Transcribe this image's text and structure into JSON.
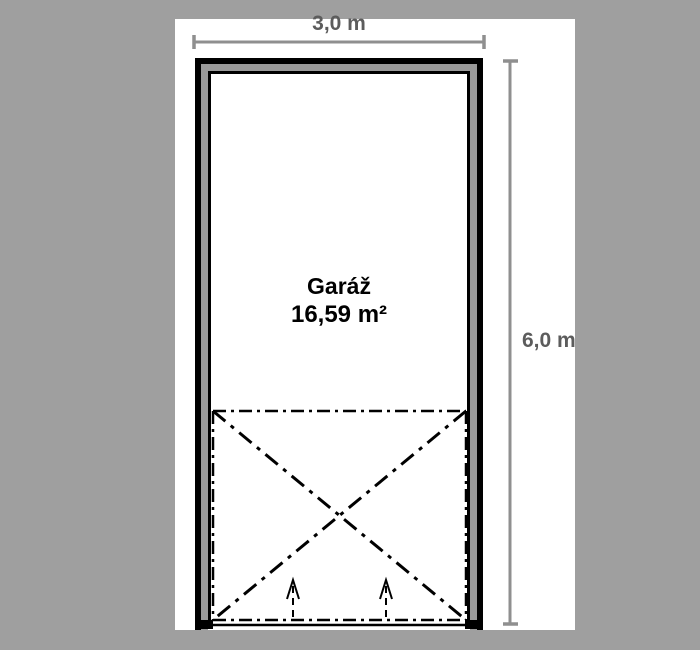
{
  "page": {
    "background_color": "#9f9f9f",
    "canvas_color": "#ffffff"
  },
  "room": {
    "name": "Garáž",
    "area": "16,59 m²"
  },
  "dimensions": {
    "width_label": "3,0 m",
    "height_label": "6,0 m"
  },
  "colors": {
    "wall_outline": "#000000",
    "wall_fill": "#9a9a9a",
    "marking": "#000000",
    "dimension_line": "#8f8f8f",
    "dimension_text": "#5c5c5c"
  }
}
